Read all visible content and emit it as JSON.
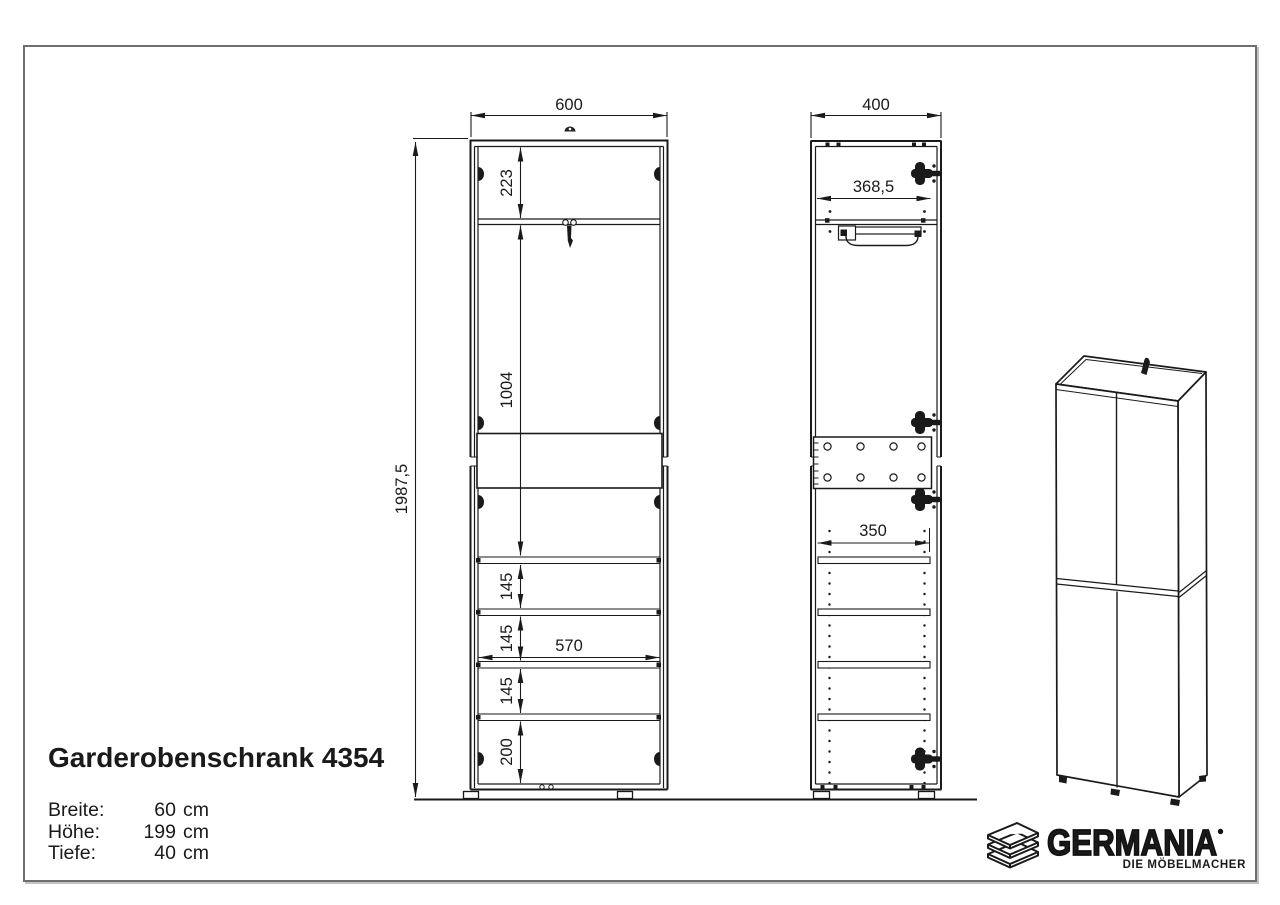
{
  "product": {
    "title": "Garderobenschrank 4354",
    "specs": [
      {
        "label": "Breite:",
        "num": "60",
        "unit": "cm"
      },
      {
        "label": "Höhe:",
        "num": "199",
        "unit": "cm"
      },
      {
        "label": "Tiefe:",
        "num": "40",
        "unit": "cm"
      }
    ]
  },
  "front_view": {
    "dim_width": "600",
    "dim_top_compartment": "223",
    "dim_wardrobe_section": "1004",
    "dim_total_height": "1987,5",
    "dim_shelf_gap_1": "145",
    "dim_shelf_gap_2": "145",
    "dim_shelf_gap_3": "145",
    "dim_bottom_compartment": "200",
    "dim_interior_width": "570"
  },
  "side_view": {
    "dim_depth": "400",
    "dim_interior_depth": "368,5",
    "dim_shelf_depth": "350"
  },
  "logo": {
    "brand": "GERMANIA",
    "tagline": "DIE MÖBELMACHER"
  },
  "colors": {
    "line": "#1a1a1a",
    "frame_border": "#6e6e6e",
    "background": "#ffffff"
  }
}
